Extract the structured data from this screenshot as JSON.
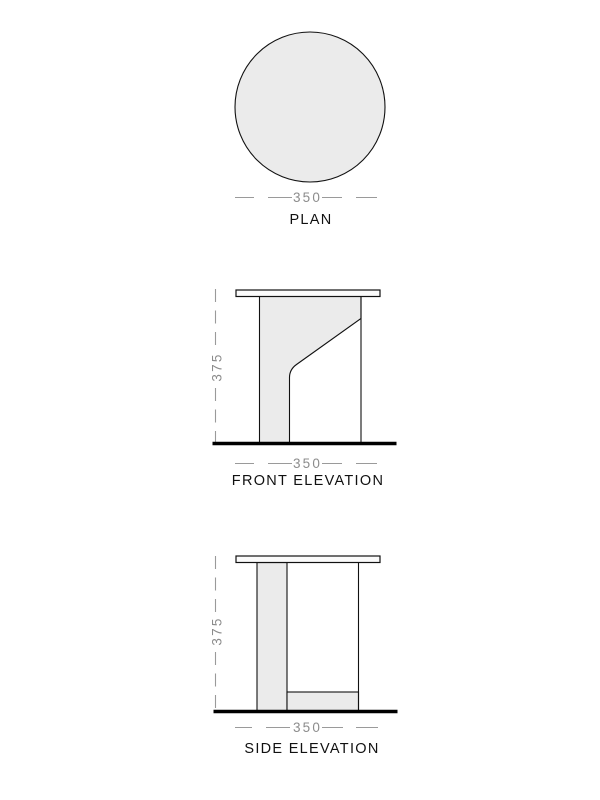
{
  "colors": {
    "surface_fill": "#ebebeb",
    "tabletop_fill": "#fbfbfb",
    "outline": "#111111",
    "ground_line": "#000000",
    "dimension_line": "#9a9a9a",
    "dimension_text": "#8c8c8c",
    "label_text": "#111111",
    "background": "#ffffff"
  },
  "views": {
    "plan": {
      "label": "PLAN",
      "width_dimension": "350"
    },
    "front_elevation": {
      "label": "FRONT ELEVATION",
      "width_dimension": "350",
      "height_dimension": "375"
    },
    "side_elevation": {
      "label": "SIDE ELEVATION",
      "width_dimension": "350",
      "height_dimension": "375"
    }
  }
}
